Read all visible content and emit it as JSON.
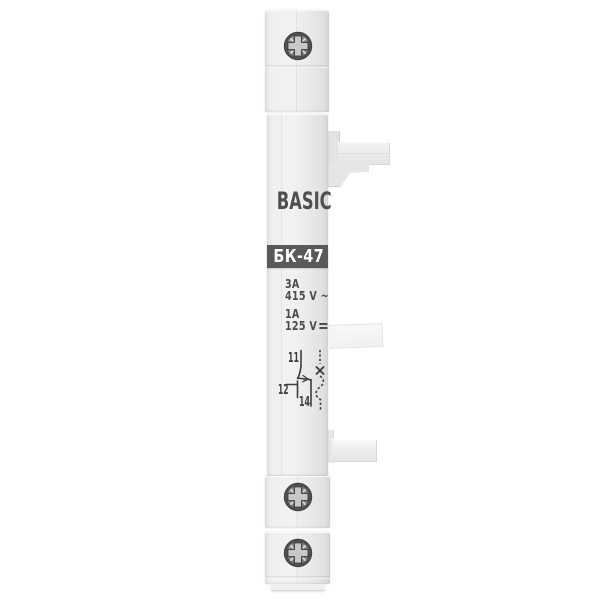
{
  "product": {
    "brand": "BASIC",
    "model": "БК-47",
    "ratings": {
      "ac_current": "3A",
      "ac_voltage": "415 V ~",
      "dc_current": "1A",
      "dc_voltage": "125 V",
      "dc_symbol": "⎓"
    },
    "diagram": {
      "terminal_top": "11",
      "terminal_nc": "12",
      "terminal_no": "14"
    },
    "colors": {
      "background": "#ffffff",
      "body_plastic": "#efefef",
      "band": "#595959",
      "band_text": "#ffffff",
      "print_text": "#4c4c4c",
      "diagram_stroke": "#3d3d3d"
    },
    "icons": {
      "screw": "pozidriv-screw-head-icon",
      "dc": "direct-current-symbol-icon"
    }
  }
}
